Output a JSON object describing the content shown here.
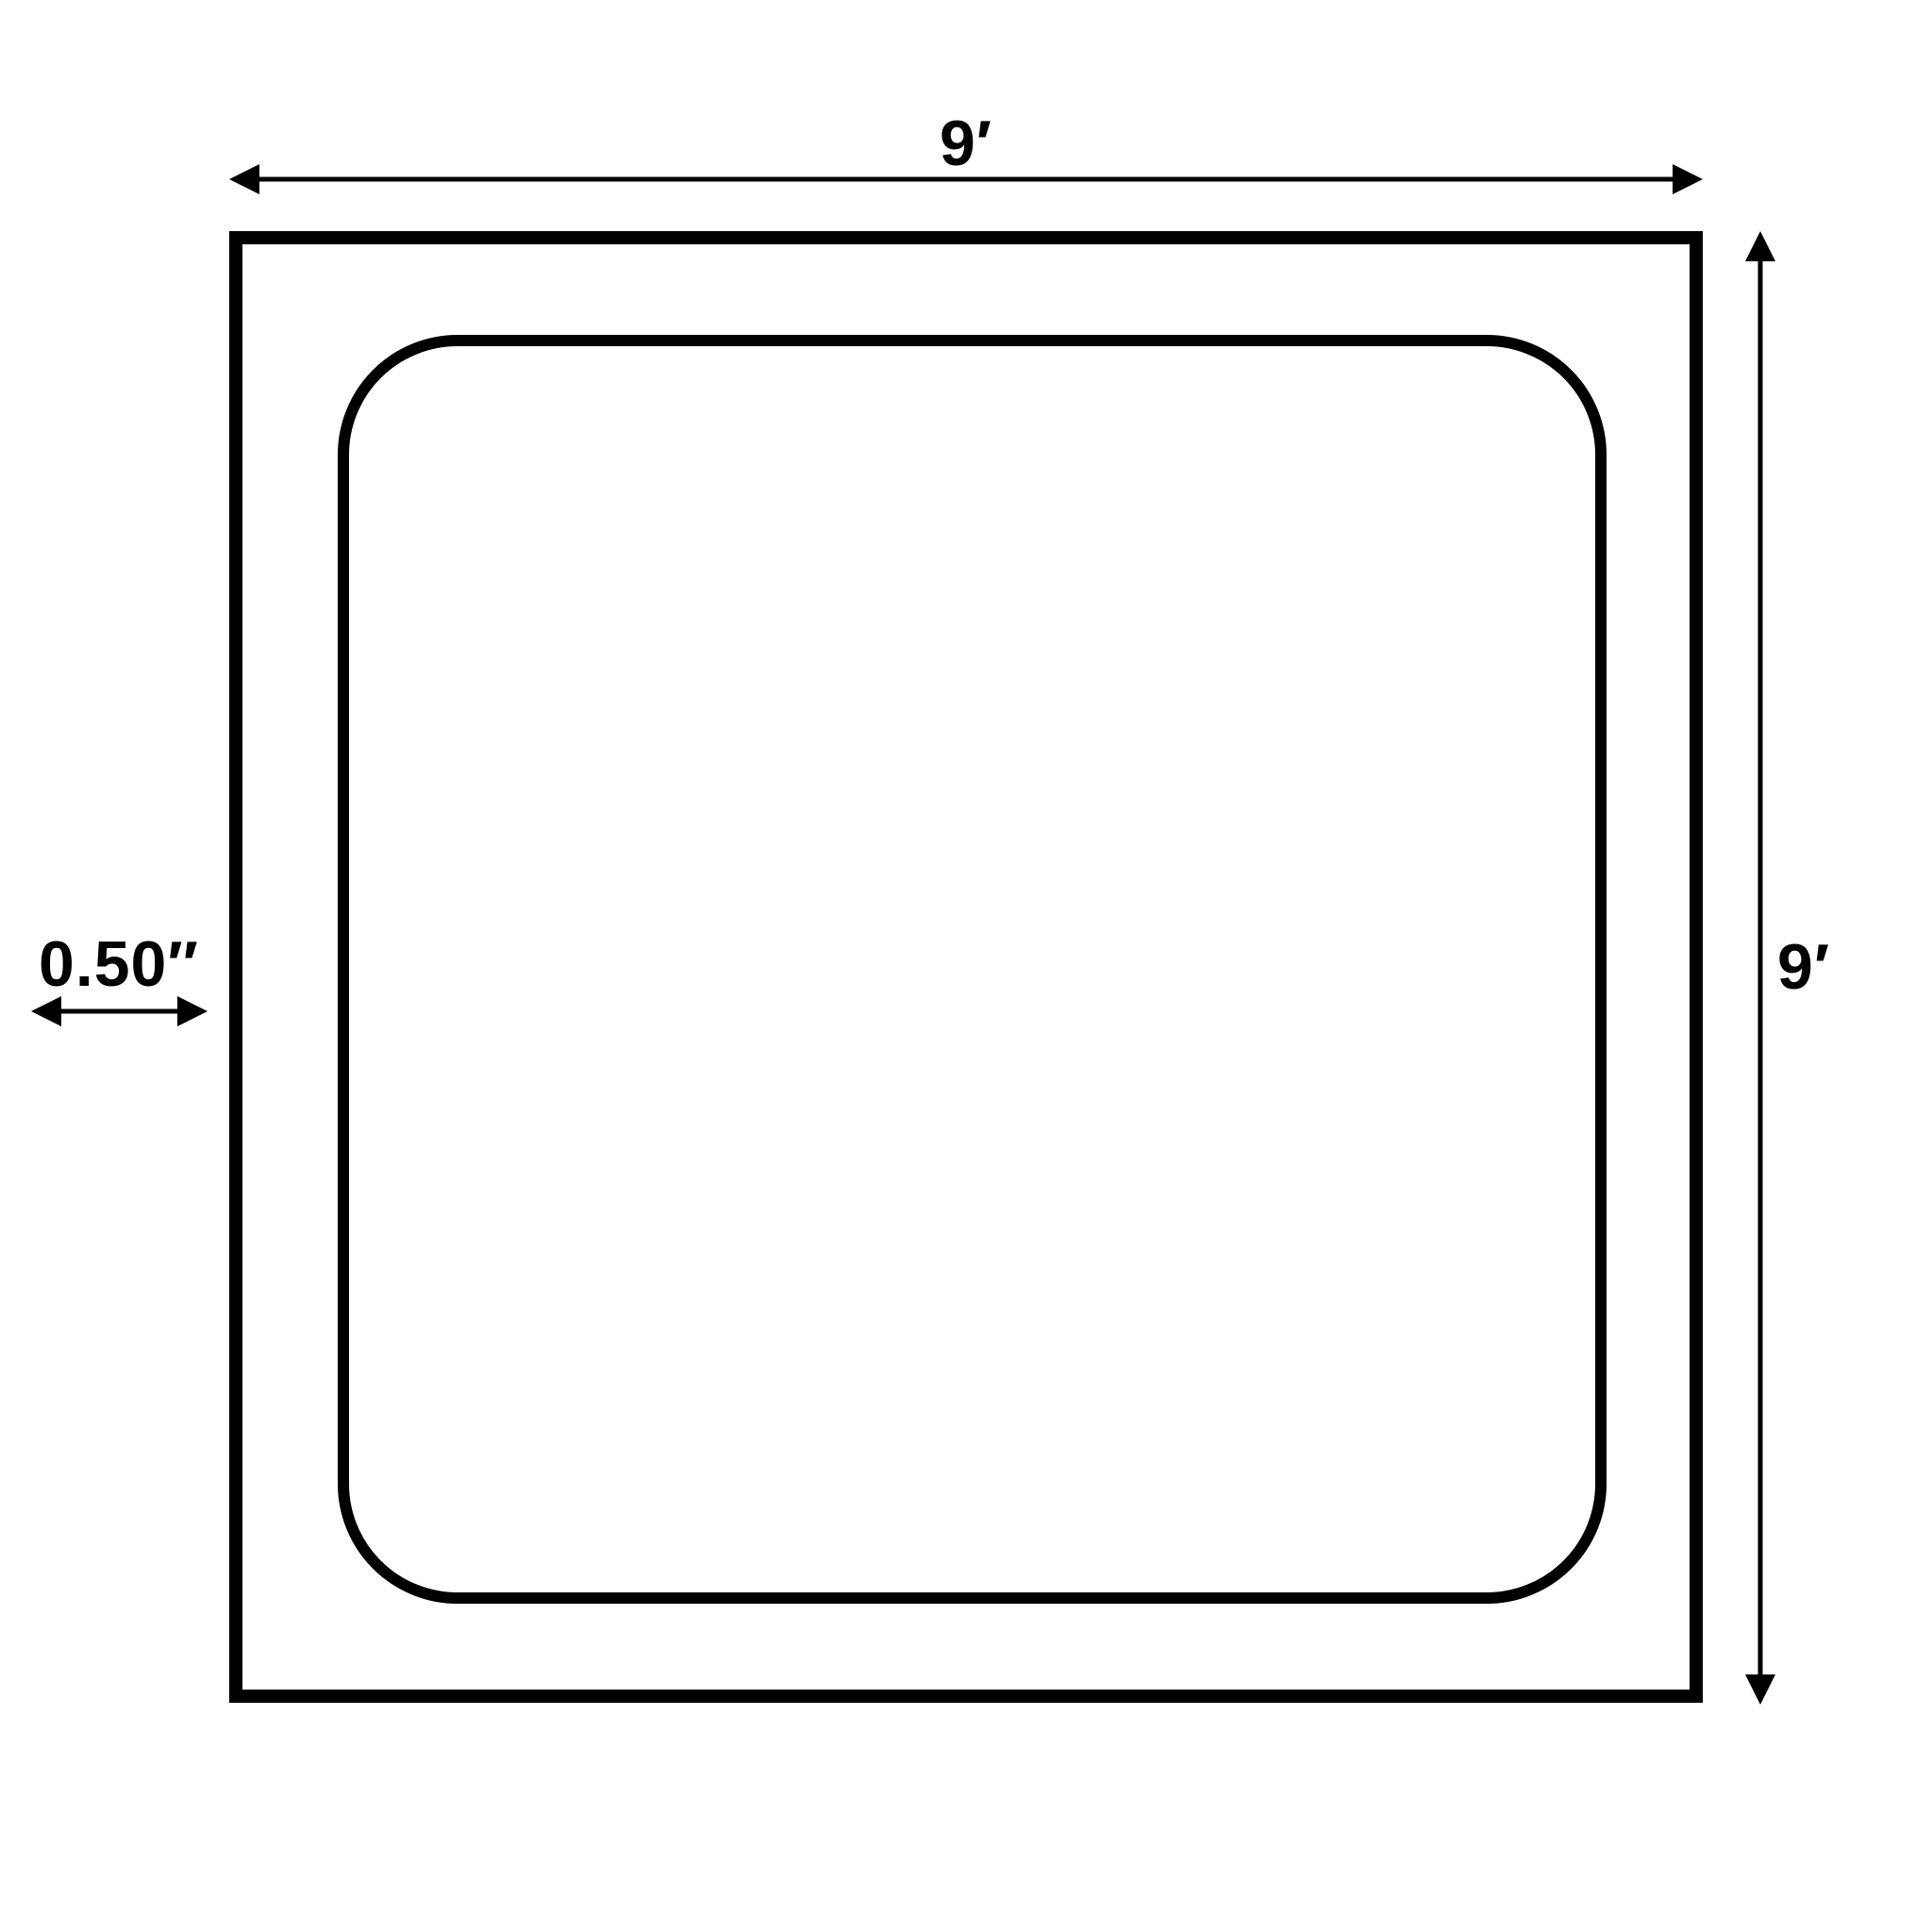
{
  "diagram": {
    "background_color": "#ffffff",
    "line_color": "#000000",
    "top_dimension": {
      "label": "9′"
    },
    "right_dimension": {
      "label": "9′"
    },
    "left_dimension": {
      "label": "0.50″"
    }
  }
}
